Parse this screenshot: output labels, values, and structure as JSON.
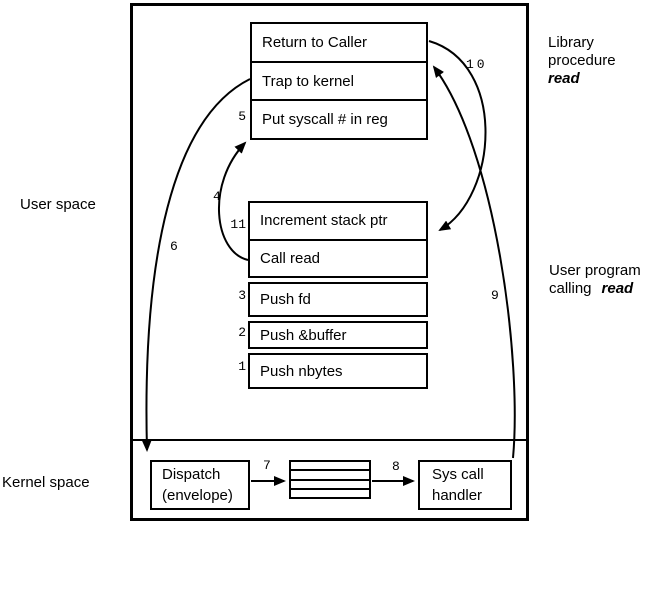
{
  "diagram": {
    "region_labels": {
      "user_space": "User space",
      "kernel_space": "Kernel space"
    },
    "captions": {
      "library": {
        "line1": "Library",
        "line2": "procedure",
        "emphasis": "read"
      },
      "user_program": {
        "line1": "User program",
        "line2_prefix": "calling",
        "emphasis": "read"
      }
    },
    "library_box": {
      "rows": [
        "Return to Caller",
        "Trap to kernel",
        "Put syscall # in reg"
      ]
    },
    "user_program_box": {
      "rows": [
        "Increment stack ptr",
        "Call read"
      ],
      "push_rows": [
        "Push fd",
        "Push &buffer",
        "Push nbytes"
      ]
    },
    "kernel": {
      "dispatch": {
        "line1": "Dispatch",
        "line2": "(envelope)"
      },
      "sys_call_handler": {
        "line1": "Sys call",
        "line2": "handler"
      },
      "handler_table_row_count": "4"
    },
    "steps": {
      "s1": "1",
      "s2": "2",
      "s3": "3",
      "s4": "4",
      "s5": "5",
      "s6": "6",
      "s7": "7",
      "s8": "8",
      "s9": "9",
      "s10": "10",
      "s11": "11"
    },
    "colors": {
      "line": "#000000",
      "background": "#ffffff",
      "text": "#000000"
    }
  }
}
